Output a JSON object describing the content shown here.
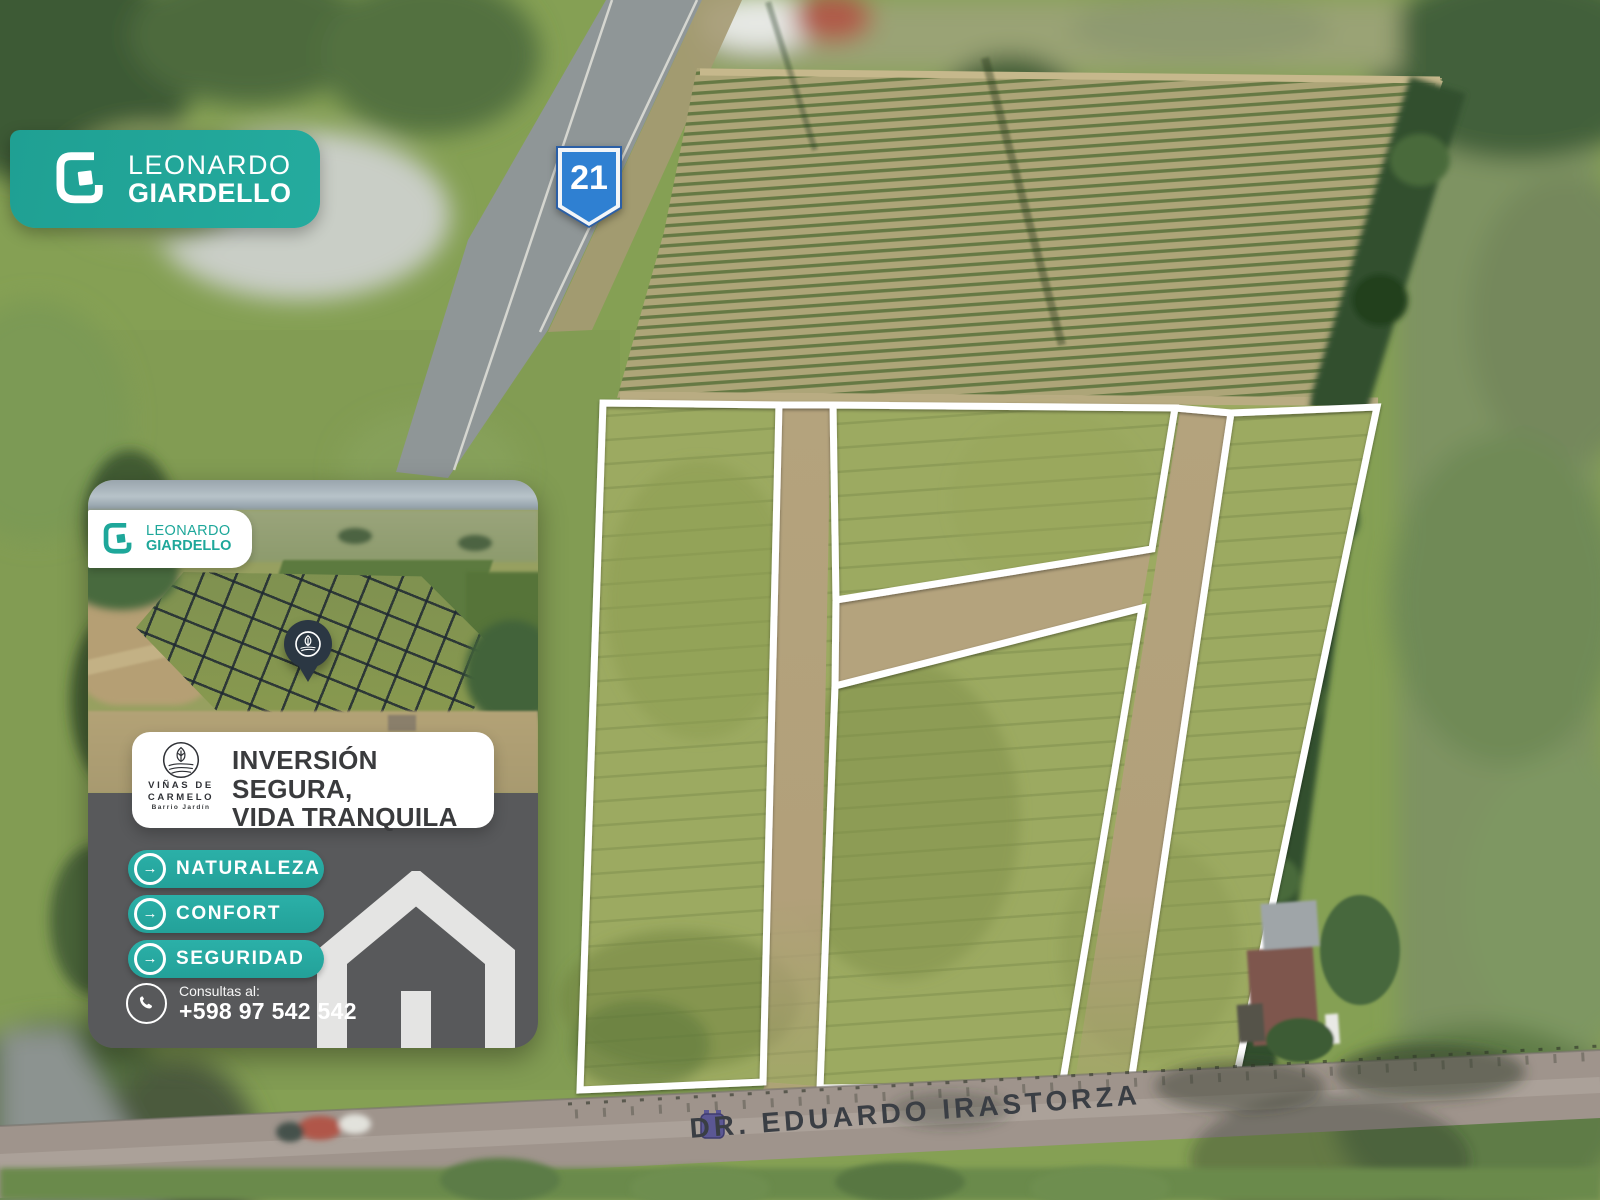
{
  "brand_badge": {
    "line1": "LEONARDO",
    "line2": "GIARDELLO"
  },
  "route_shield": {
    "number": "21"
  },
  "card": {
    "badge": {
      "line1": "LEONARDO",
      "line2": "GIARDELLO"
    },
    "headline_line1": "INVERSIÓN SEGURA,",
    "headline_line2": "VIDA TRANQUILA",
    "brand_logo": {
      "line1": "VIÑAS DE",
      "line2": "CARMELO",
      "tagline": "Barrio Jardín"
    },
    "features": [
      {
        "label": "NATURALEZA"
      },
      {
        "label": "CONFORT"
      },
      {
        "label": "SEGURIDAD"
      }
    ],
    "contact": {
      "label": "Consultas al:",
      "phone": "+598 97 542 542"
    },
    "feature_icon": "→"
  },
  "map_overlay": {
    "street_label": "DR. EDUARDO IRASTORZA"
  },
  "colors": {
    "teal": "#21A79B",
    "panel_gray": "#58595B",
    "shield_blue": "#2F80D2",
    "outline_white": "#FFFFFF",
    "grass": "#9CAA61",
    "dirt": "#B4A37D"
  }
}
